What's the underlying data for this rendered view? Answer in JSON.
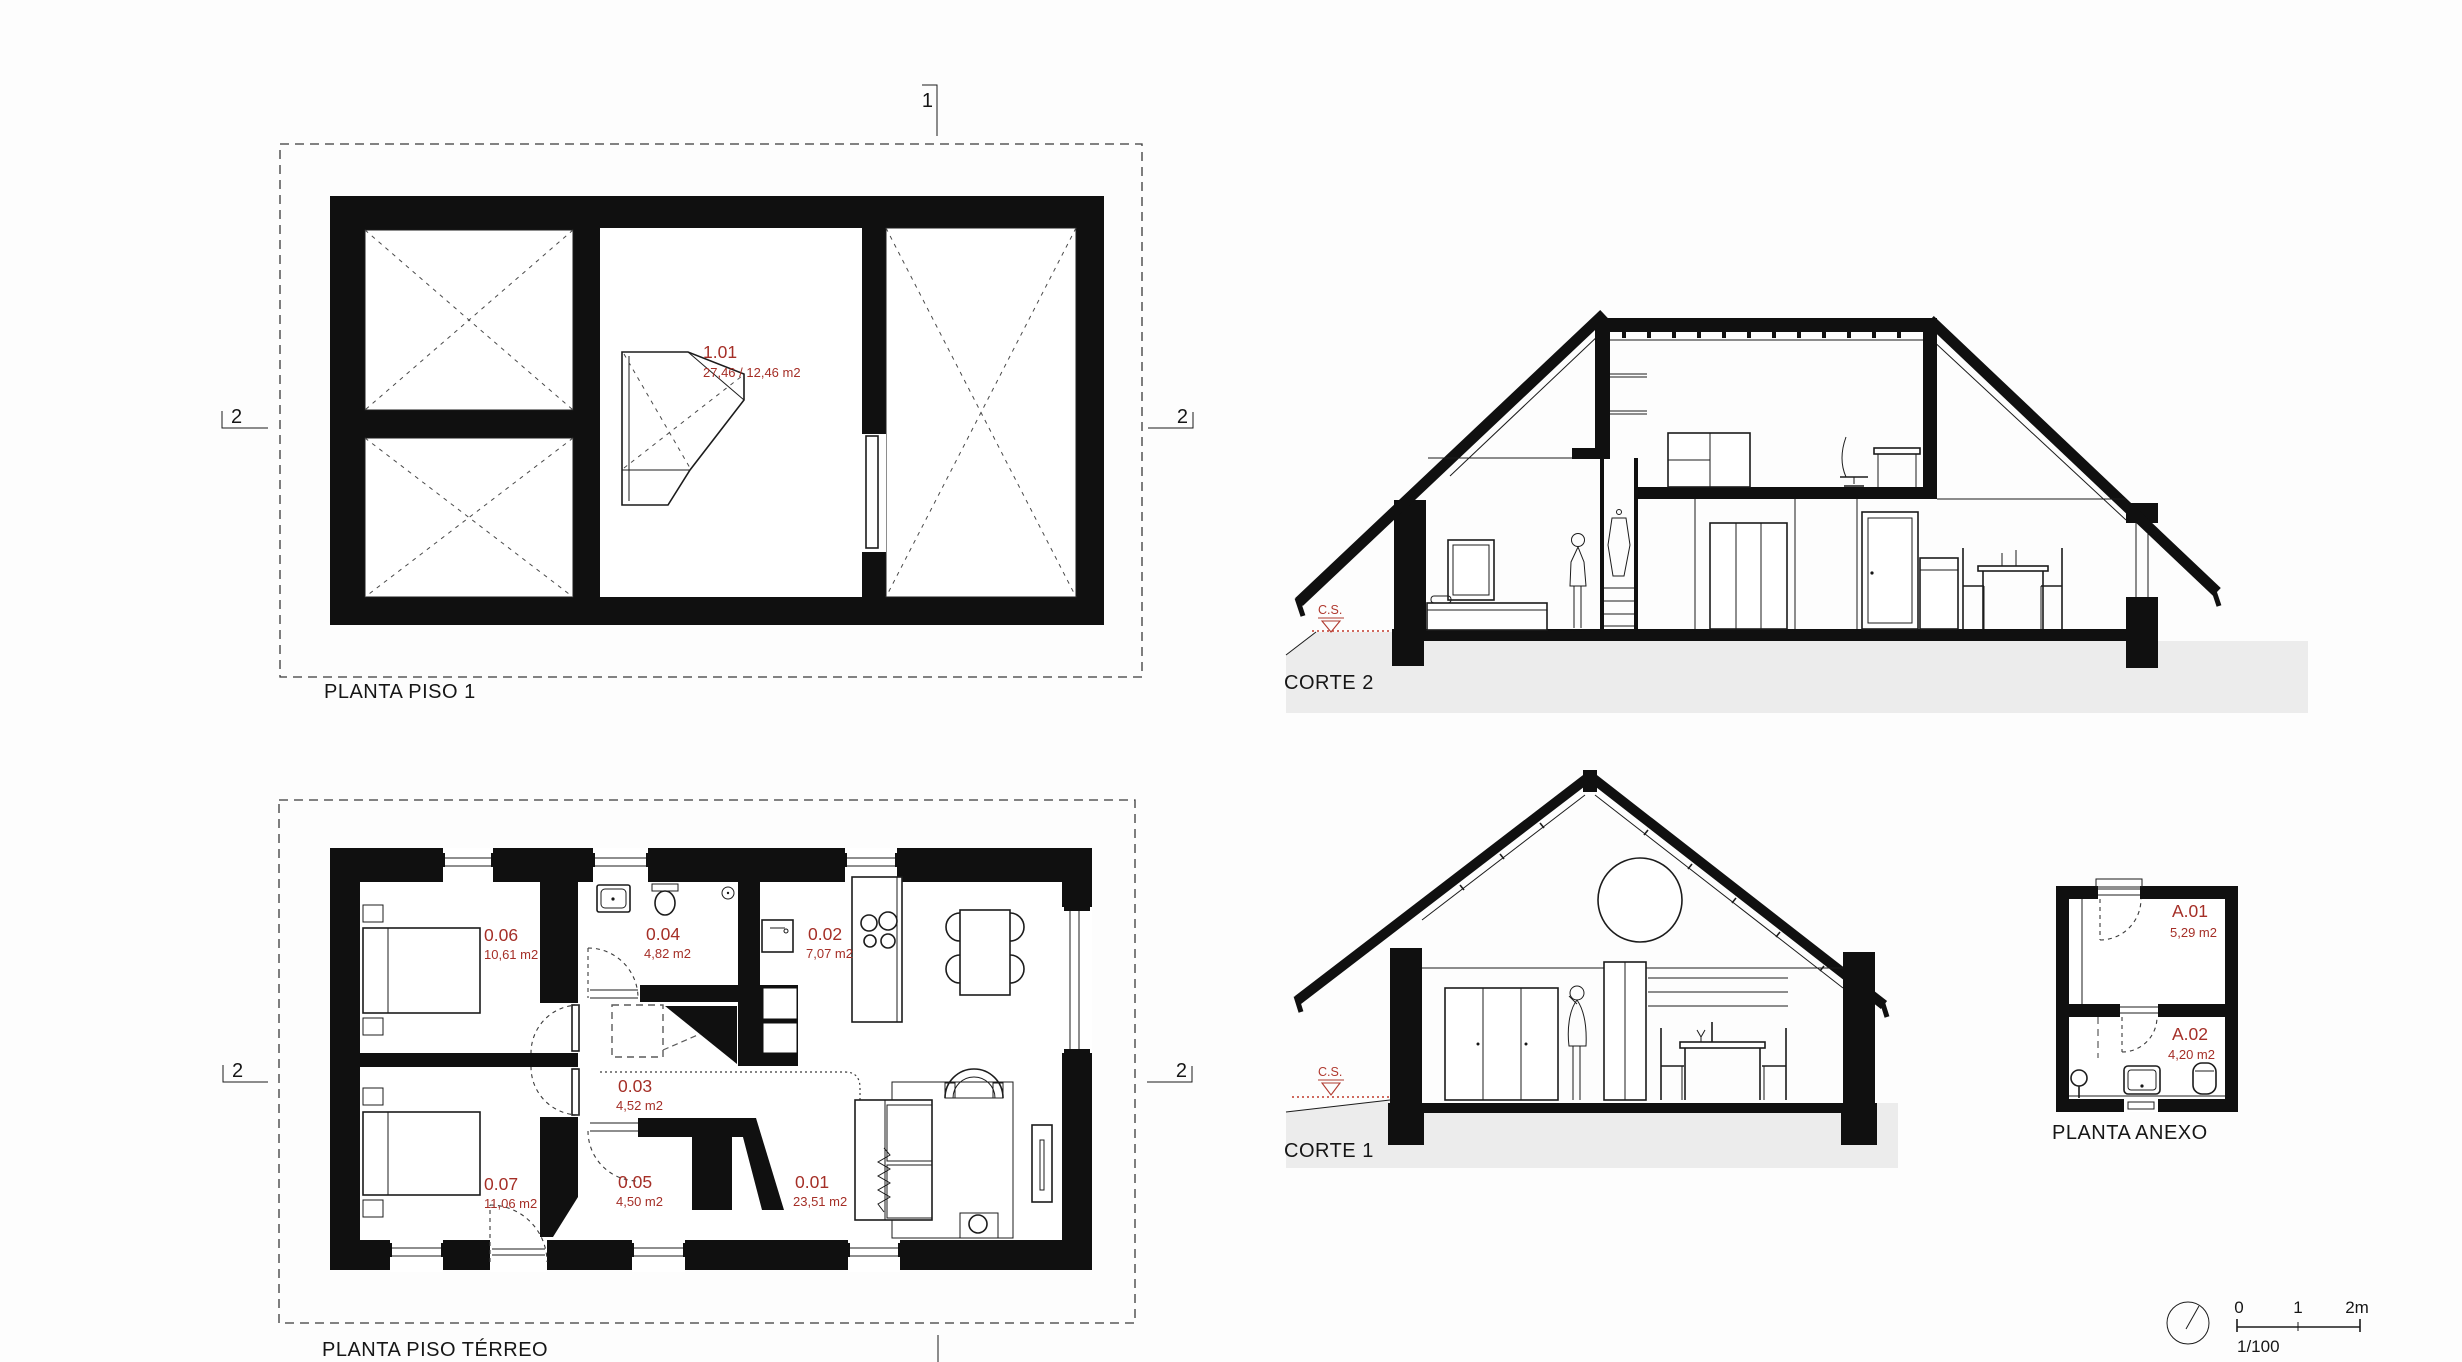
{
  "colors": {
    "annotation_red": "#a52f27",
    "ground_gray": "#ececec",
    "line_black": "#161616"
  },
  "piso1": {
    "label": "PLANTA PISO 1",
    "room": {
      "id": "1.01",
      "area": "27,46 / 12,46 m2"
    },
    "markers": {
      "top": "1",
      "left": "2",
      "right": "2"
    }
  },
  "terreo": {
    "label": "PLANTA PISO TÉRREO",
    "markers": {
      "left": "2",
      "right": "2"
    },
    "rooms": [
      {
        "id": "0.06",
        "area": "10,61 m2"
      },
      {
        "id": "0.04",
        "area": "4,82 m2"
      },
      {
        "id": "0.02",
        "area": "7,07 m2"
      },
      {
        "id": "0.03",
        "area": "4,52 m2"
      },
      {
        "id": "0.07",
        "area": "11,06 m2"
      },
      {
        "id": "0.05",
        "area": "4,50 m2"
      },
      {
        "id": "0.01",
        "area": "23,51 m2"
      }
    ]
  },
  "corte2": {
    "label": "CORTE 2",
    "ground_marker": "C.S."
  },
  "corte1": {
    "label": "CORTE 1",
    "ground_marker": "C.S."
  },
  "anexo": {
    "label": "PLANTA ANEXO",
    "rooms": [
      {
        "id": "A.01",
        "area": "5,29 m2"
      },
      {
        "id": "A.02",
        "area": "4,20 m2"
      }
    ]
  },
  "scale_bar": {
    "tick0": "0",
    "tick1": "1",
    "tick2": "2m",
    "ratio": "1/100"
  }
}
